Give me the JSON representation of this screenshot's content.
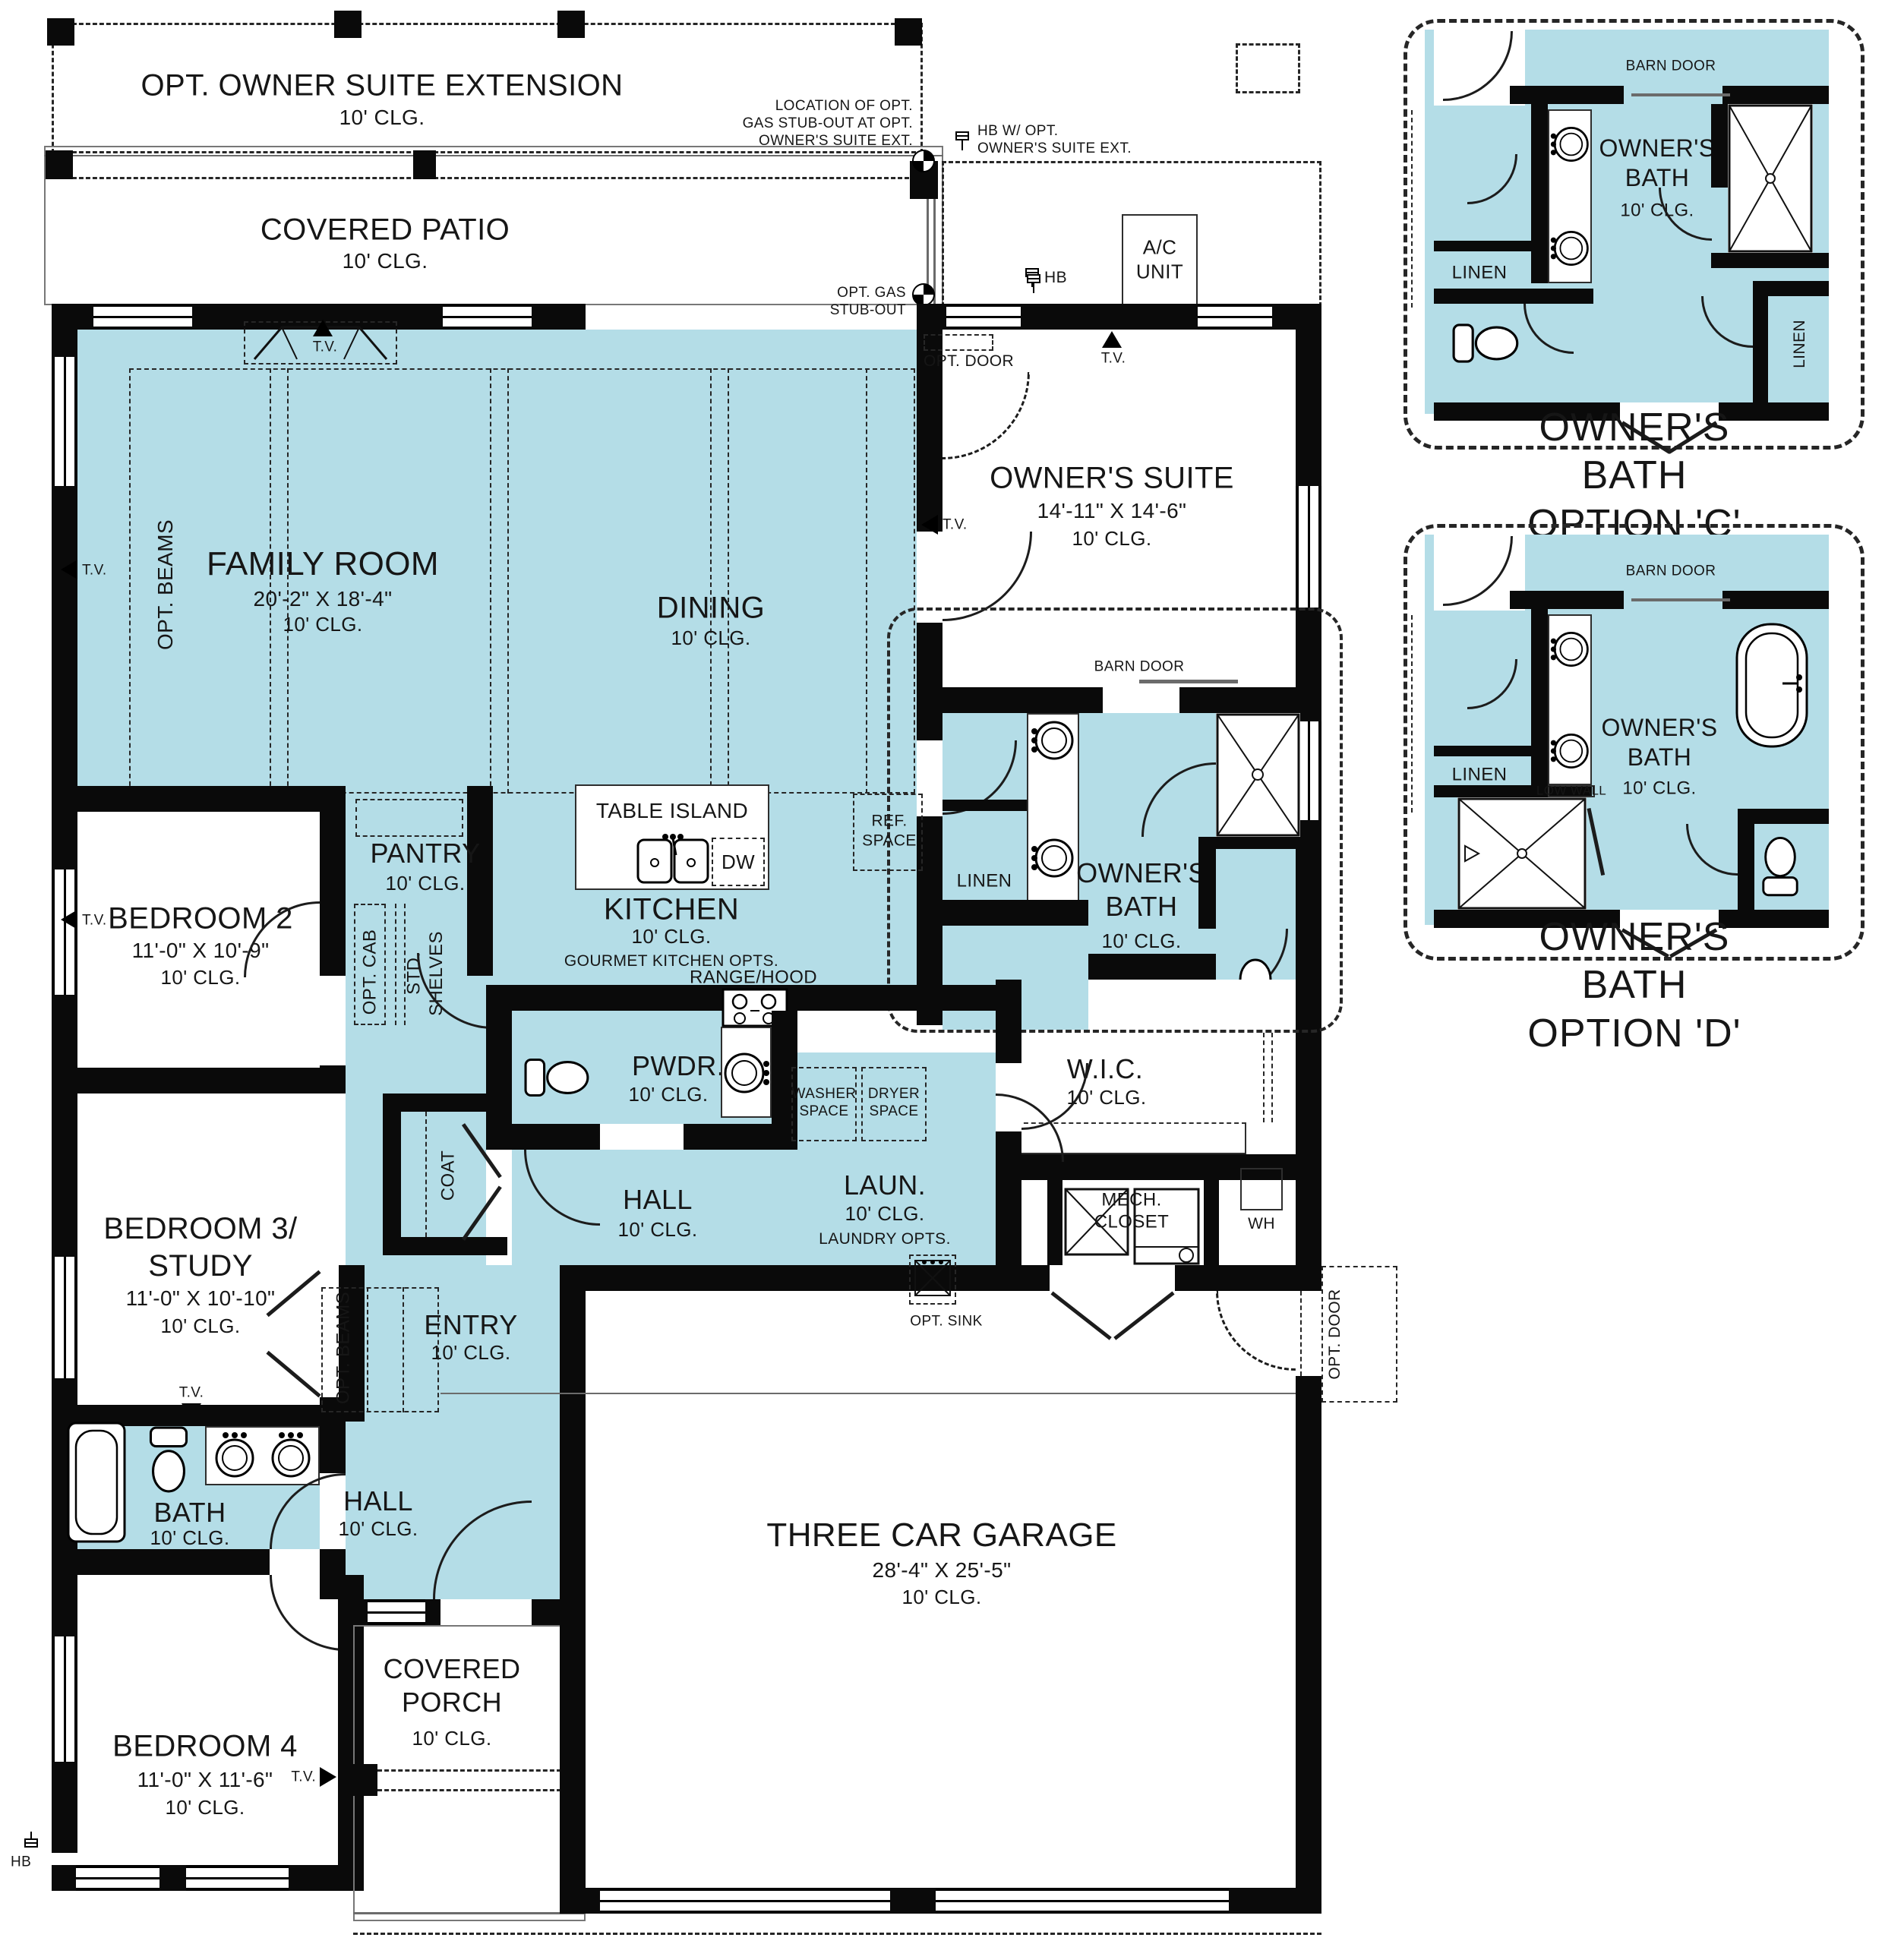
{
  "colors": {
    "room_fill": "#b4dde7",
    "wall": "#0a0a0a",
    "background": "#ffffff"
  },
  "plan": {
    "ext": {
      "title": "OPT. OWNER SUITE EXTENSION"
    },
    "patio": {
      "title": "COVERED PATIO"
    },
    "family": {
      "name": "FAMILY ROOM",
      "dims": "20'-2\" X 18'-4\""
    },
    "dining": {
      "name": "DINING"
    },
    "suite": {
      "name": "OWNER'S SUITE",
      "dims": "14'-11\" X 14'-6\""
    },
    "kitchen": {
      "name": "KITCHEN",
      "opts": "GOURMET KITCHEN OPTS."
    },
    "pantry": {
      "name": "PANTRY"
    },
    "bed2": {
      "name": "BEDROOM 2",
      "dims": "11'-0\" X 10'-9\""
    },
    "bed3": {
      "name": "BEDROOM 3/\nSTUDY",
      "dims": "11'-0\" X 10'-10\""
    },
    "bed4": {
      "name": "BEDROOM 4",
      "dims": "11'-0\" X 11'-6\""
    },
    "bath_main": {
      "name": "OWNER'S\nBATH"
    },
    "wic": {
      "name": "W.I.C."
    },
    "pwdr": {
      "name": "PWDR."
    },
    "laun": {
      "name": "LAUN.",
      "opts": "LAUNDRY OPTS."
    },
    "hall": {
      "name": "HALL"
    },
    "entry": {
      "name": "ENTRY"
    },
    "bath2": {
      "name": "BATH"
    },
    "garage": {
      "name": "THREE CAR GARAGE",
      "dims": "28'-4\" X 25'-5\""
    },
    "porch": {
      "name": "COVERED\nPORCH"
    }
  },
  "notes": {
    "clg10": "10' CLG.",
    "location": "LOCATION OF OPT.\nGAS STUB-OUT AT OPT.\nOWNER'S SUITE EXT.",
    "hb_ext": "HB W/ OPT.\nOWNER'S SUITE EXT.",
    "ac": "A/C\nUNIT",
    "hb": "HB",
    "tv": "T.V.",
    "opt_door": "OPT. DOOR",
    "opt_gas": "OPT. GAS\nSTUB-OUT",
    "opt_fireplace": "OPT. FIREPLACE",
    "opt_beams": "OPT. BEAMS",
    "barn_door": "BARN DOOR",
    "table_island": "TABLE ISLAND",
    "dw": "DW",
    "range_hood": "RANGE/HOOD",
    "ref_space": "REF.\nSPACE",
    "linen": "LINEN",
    "washer": "WASHER\nSPACE",
    "dryer": "DRYER\nSPACE",
    "mech": "MECH.\nCLOSET",
    "wh": "WH",
    "coat": "COAT",
    "opt_cab": "OPT. CAB",
    "std_shelves": "STD.\nSHELVES",
    "opt_sink": "OPT. SINK",
    "low_wall": "LOW WALL"
  },
  "insets": {
    "c": {
      "title": "OWNER'S BATH OPTION 'C'"
    },
    "d": {
      "title": "OWNER'S BATH OPTION 'D'"
    }
  }
}
